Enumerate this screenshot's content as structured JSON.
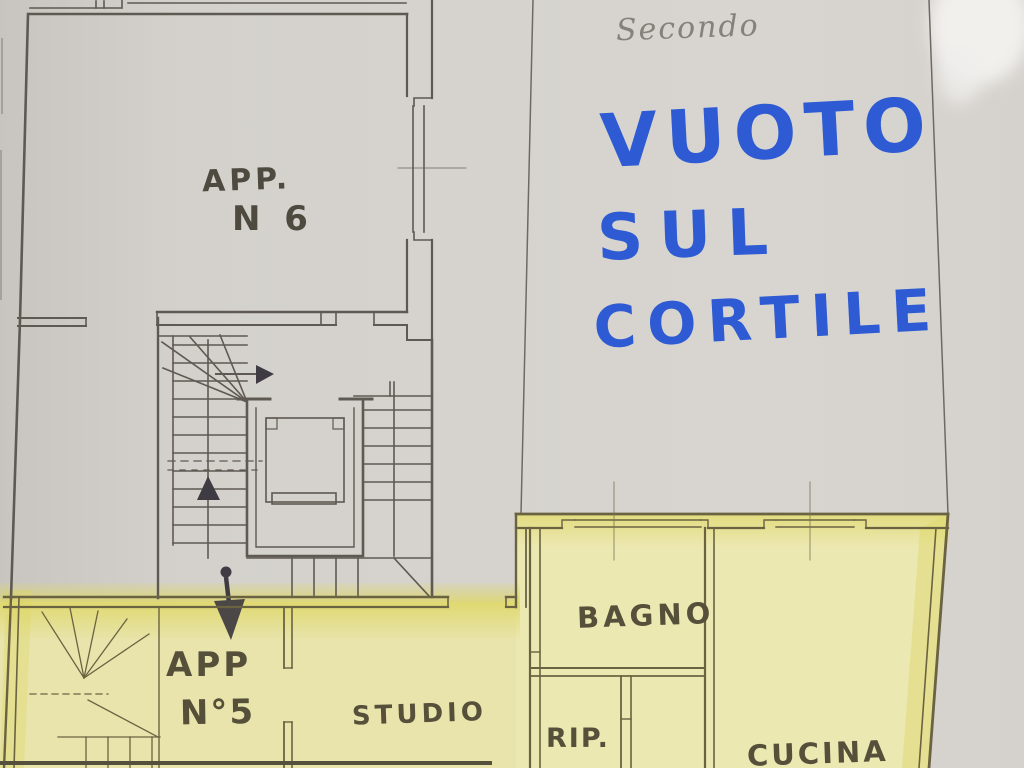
{
  "floor_label": "Secondo",
  "blue_note": {
    "line1": "VUOTO",
    "line2": "SUL",
    "line3": "CORTILE"
  },
  "rooms": {
    "app6_line1": "APP.",
    "app6_line2": "N 6",
    "app5_line1": "APP",
    "app5_line2": "N°5",
    "studio": "STUDIO",
    "bagno": "BAGNO",
    "rip": "RIP.",
    "cucina": "CUCINA"
  },
  "colors": {
    "paper": "#d6d3ce",
    "apartment_fill_left": "#e8e4ac",
    "apartment_fill_right": "#ece8b2",
    "highlighter": "#ded768",
    "ink_gray_area": "#5e5952",
    "ink_yellow_area": "#6a6342",
    "marker_blue": "#2e5bd4",
    "pencil_gray": "#85817b",
    "arrow_black": "#3f3b43"
  }
}
